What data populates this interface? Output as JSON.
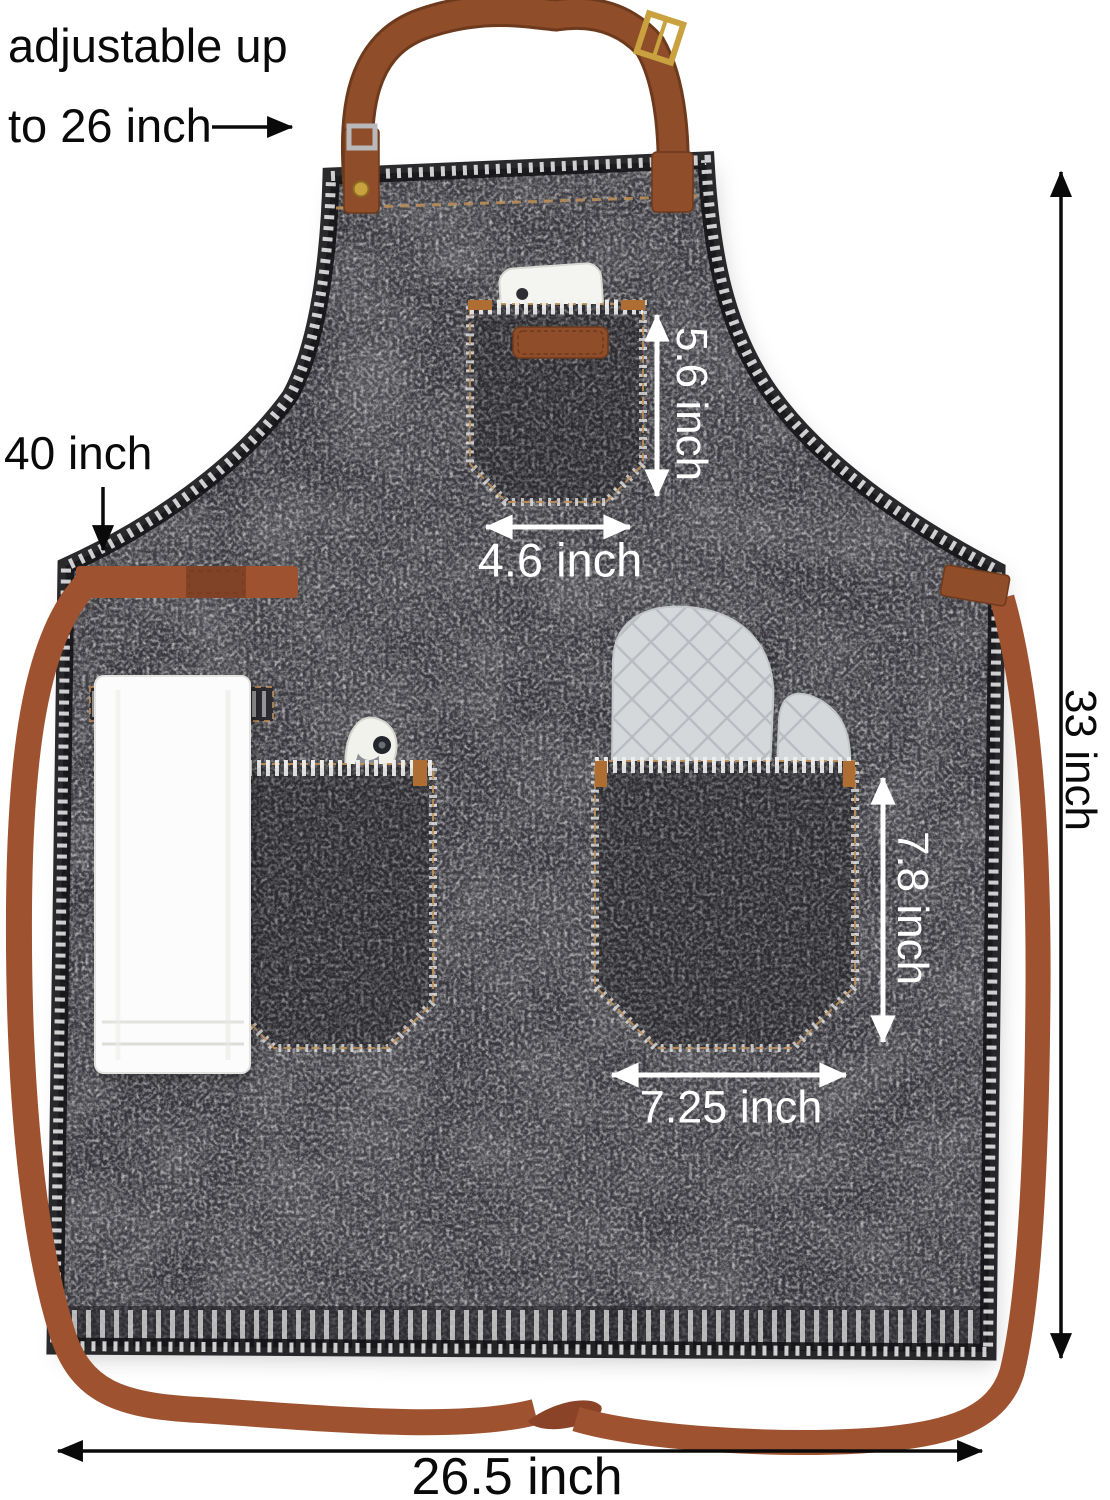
{
  "annotations": {
    "neck_strap_note": {
      "line1": "adjustable up",
      "line2": "to 26 inch"
    },
    "waist_strap_length": "40 inch",
    "apron_height": "33 inch",
    "apron_width": "26.5 inch",
    "chest_pocket_height": "5.6 inch",
    "chest_pocket_width": "4.6 inch",
    "front_pocket_height": "7.8 inch",
    "front_pocket_width": "7.25 inch"
  },
  "objects": {
    "apron": "black-wash denim apron",
    "neck_strap": "adjustable brown leather neck strap with buckle",
    "waist_straps": "long brown waist ties",
    "chest_pocket_items": "phone",
    "left_pocket_items": "bottle opener, hanging white towel",
    "right_pocket_items": "gray quilted oven mitts"
  },
  "colors": {
    "background": "#ffffff",
    "denim": "#35353a",
    "denim-pocket": "#2b2b30",
    "stitch-white": "#efefee",
    "stitch-tan": "#c09058",
    "leather": "#8f4d2a",
    "leather-edge": "#6e3a1d",
    "webbing": "#9e5230",
    "buckle-gold": "#c9a23f",
    "bartack-orange": "#ad6d33",
    "mitt-gray": "#d5d8db",
    "mitt-line": "#b7babd",
    "towel-white": "#fcfcfc",
    "annotation-black": "#0a0a0a",
    "annotation-white": "#ffffff"
  }
}
